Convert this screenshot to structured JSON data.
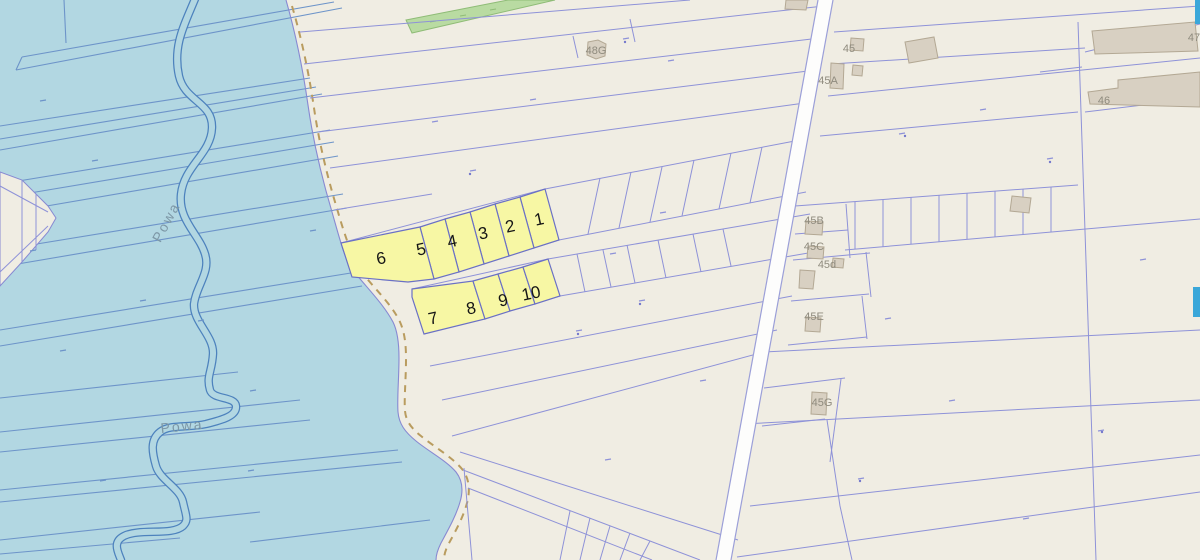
{
  "map": {
    "background_color": "#f0ede3",
    "water_color": "#b2d7e2",
    "water_line_color": "#6d94c9",
    "parcel_line_color": "#8e92d8",
    "highlight_fill": "#f7f7a4",
    "highlight_border": "#6a70c5",
    "road_fill": "#fdfdfc",
    "road_edge_color": "#9b9fd8",
    "building_fill": "#d8d0c2",
    "building_border": "#b3a894",
    "building_label_color": "#8f8b7e",
    "river_label_color": "#7d97a6",
    "shore_dash_color": "#b99c5f",
    "green_area_color": "#b9dba2",
    "edge_widget_color": "#3aa7d9",
    "highlighted_parcels": [
      {
        "label": "1"
      },
      {
        "label": "2"
      },
      {
        "label": "3"
      },
      {
        "label": "4"
      },
      {
        "label": "5"
      },
      {
        "label": "6"
      },
      {
        "label": "7"
      },
      {
        "label": "8"
      },
      {
        "label": "9"
      },
      {
        "label": "10"
      }
    ],
    "building_labels": [
      {
        "label": "48G"
      },
      {
        "label": "45"
      },
      {
        "label": "45A"
      },
      {
        "label": "45B"
      },
      {
        "label": "45C"
      },
      {
        "label": "45d"
      },
      {
        "label": "45E"
      },
      {
        "label": "45G"
      },
      {
        "label": "46"
      },
      {
        "label": "47"
      }
    ],
    "river_labels": [
      {
        "label": "Powa"
      },
      {
        "label": "Powa"
      }
    ]
  }
}
